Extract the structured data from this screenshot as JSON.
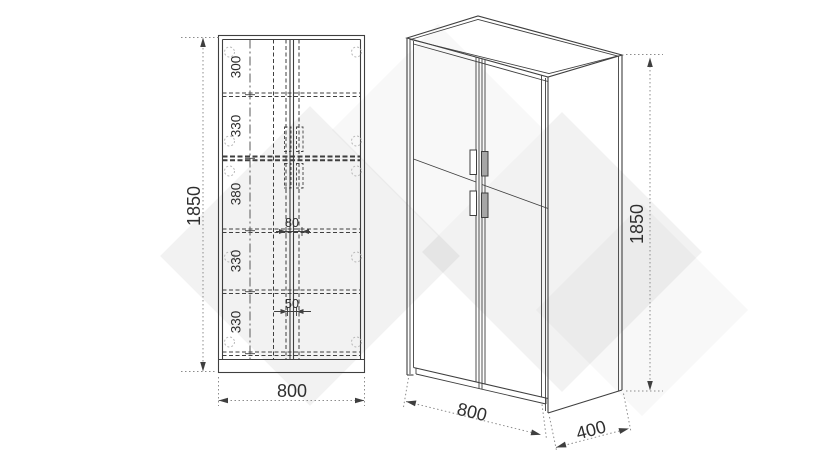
{
  "front_view": {
    "height": "1850",
    "width": "800",
    "sections": [
      "300",
      "330",
      "380",
      "330",
      "330"
    ],
    "center_gap_upper": "80",
    "center_gap_lower": "50"
  },
  "iso_view": {
    "height": "1850",
    "width": "800",
    "depth": "400"
  },
  "colors": {
    "line": "#3f3f3f",
    "dim": "#8c8c8c",
    "text": "#2f2f2f",
    "hinge": "#b8b8b8",
    "handle_fill": "#a6a6a6",
    "watermark": "rgba(0,0,0,0.05)"
  }
}
